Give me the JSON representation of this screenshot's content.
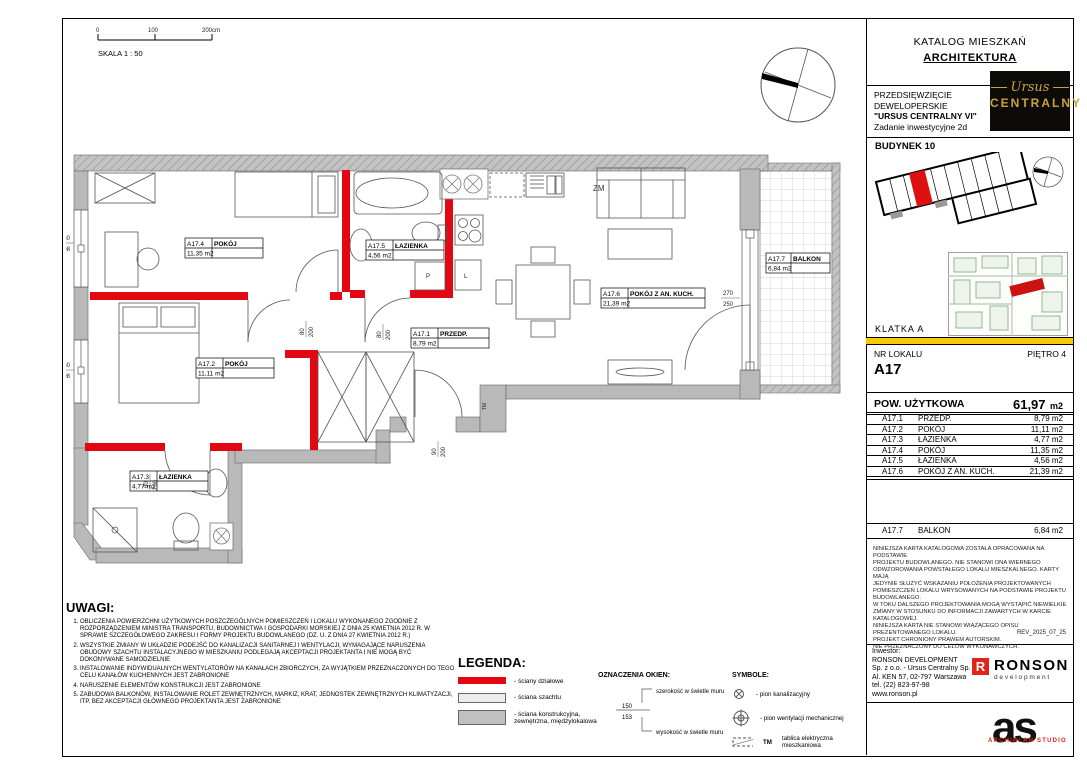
{
  "header": {
    "catalog_title": "KATALOG MIESZKAŃ",
    "catalog_subtitle": "ARCHITEKTURA"
  },
  "project": {
    "line1": "PRZEDSIĘWZIĘCIE",
    "line2": "DEWELOPERSKIE",
    "line3": "\"URSUS CENTRALNY VI\"",
    "line4": "Zadanie inwestycyjne 2d",
    "brand_script": "Ursus",
    "brand_caps": "CENTRALNY"
  },
  "building": {
    "name": "BUDYNEK 10",
    "klatka": "KLATKA  A"
  },
  "unit": {
    "nr_label": "NR LOKALU",
    "nr_value": "A17",
    "floor": "PIĘTRO 4",
    "area_label": "POW. UŻYTKOWA",
    "area_value": "61,97",
    "area_unit": "m2"
  },
  "rooms": [
    {
      "id": "A17.1",
      "name": "PRZEDP.",
      "area": "8,79 m2"
    },
    {
      "id": "A17.2",
      "name": "POKÓJ",
      "area": "11,11 m2"
    },
    {
      "id": "A17.3",
      "name": "ŁAZIENKA",
      "area": "4,77 m2"
    },
    {
      "id": "A17.4",
      "name": "POKÓJ",
      "area": "11,35 m2"
    },
    {
      "id": "A17.5",
      "name": "ŁAZIENKA",
      "area": "4,56 m2"
    },
    {
      "id": "A17.6",
      "name": "POKÓJ Z AN. KUCH.",
      "area": "21,39 m2"
    }
  ],
  "balcony": {
    "id": "A17.7",
    "name": "BALKON",
    "area": "6,84 m2"
  },
  "plan": {
    "scale_label": "SKALA 1 : 50",
    "tick0": "0",
    "tick1": "100",
    "tick2": "200cm",
    "zm": "ZM",
    "tm": "TM",
    "cab_p": "P",
    "cab_l": "L",
    "dims": {
      "door_w": "80",
      "door_h": "200",
      "entr_w": "90",
      "balc_w": "270",
      "balc_h": "250",
      "win_w": "160",
      "win_h": "198"
    }
  },
  "uwagi": {
    "title": "UWAGI:",
    "items": [
      "OBLICZENIA POWIERZCHNI UŻYTKOWYCH POSZCZEGÓLNYCH POMIESZCZEŃ I LOKALU WYKONANEGO ZGODNIE Z ROZPORZĄDZENIEM MINISTRA TRANSPORTU, BUDOWNICTWA I GOSPODARKI MORSKIEJ Z DNIA 25 KWIETNIA 2012 R. W SPRAWIE SZCZEGÓŁOWEGO ZAKRESU I FORMY PROJEKTU BUDOWLANEGO (DZ. U. Z DNIA 27 KWIETNIA 2012 R.)",
      "WSZYSTKIE ZMIANY W UKŁADZIE PODEJŚĆ DO KANALIZACJI SANITARNEJ I WENTYLACJI, WYMAGAJĄCE NARUSZENIA OBUDOWY SZACHTU INSTALACYJNEGO W MIESZKANIU PODLEGAJĄ AKCEPTACJI PROJEKTANTA I NIE MOGĄ BYĆ DOKONYWANE SAMODZIELNIE",
      "INSTALOWANIE INDYWIDUALNYCH WENTYLATORÓW NA KANAŁACH ZBIORCZYCH, ZA WYJĄTKIEM PRZEZNACZONYCH DO TEGO CELU KANAŁÓW KUCHENNYCH JEST ZABRONIONE",
      "NARUSZENIE ELEMENTÓW KONSTRUKCJI JEST ZABRONIONE",
      "ZABUDOWA BALKONÓW, INSTALOWANIE ROLET ZEWNĘTRZNYCH, MARKIZ, KRAT, JEDNOSTEK ZEWNĘTRZNYCH KLIMATYZACJI, ITP. BEZ AKCEPTACJI GŁÓWNEGO PROJEKTANTA JEST ZABRONIONE"
    ]
  },
  "legend": {
    "title": "LEGENDA:",
    "item1": "- ściany działowe",
    "item2": "- ściana szachtu",
    "item3": "- ściana konstrukcyjna, zewnętrzna, międzylokalowa"
  },
  "windows_key": {
    "title": "OZNACZENIA OKIEN:",
    "width_label": "szerokość w świetle muru",
    "height_label": "wysokość w świetle muru",
    "sample_w": "150",
    "sample_h": "153"
  },
  "symbols": {
    "title": "SYMBOLE:",
    "item1": "- pion kanalizacyjny",
    "item2": "- pion wentylacji mechanicznej",
    "tm_abbr": "TM",
    "tm_label": "tablica elektryczna mieszkaniowa"
  },
  "legal": {
    "lines": [
      "NINIEJSZA KARTA KATALOGOWA ZOSTAŁA OPRACOWANA NA PODSTAWIE",
      "PROJEKTU BUDOWLANEGO. NIE STANOWI ONA WIERNEGO",
      "ODWZOROWANIA POWSTAŁEGO LOKALU MIESZKALNEGO. KARTY MAJĄ",
      "JEDYNIE SŁUŻYĆ WSKAZANIU POŁOŻENIA PROJEKTOWANYCH",
      "POMIESZCZEŃ LOKALU WRYSOWANYCH NA PODSTAWIE PROJEKTU",
      "BUDOWLANEGO.",
      "W TOKU DALSZEGO PROJEKTOWANIA MOGĄ WYSTĄPIĆ NIEWIELKIE",
      "ZMIANY W STOSUNKU DO INFORMACJI ZAWARTYCH W KARCIE",
      "KATALOGOWEJ.",
      "NINIEJSZA KARTA NIE STANOWI WIĄŻĄCEGO OPISU PREZENTOWANEGO LOKALU.",
      "PROJEKT CHRONIONY PRAWEM AUTORSKIM.",
      "NIE PRZEZNACZONY DO CELÓW WYKONAWCZYCH."
    ],
    "rev": "REV_2025_07_25"
  },
  "investor": {
    "label": "Inwestor:",
    "lines": [
      "RONSON DEVELOPMENT",
      "Sp. z o.o. - Ursus Centralny Sp. K.",
      "Al. KEN 57, 02-797 Warszawa",
      "tel. (22) 823-97-98",
      "www.ronson.pl"
    ],
    "logo_r": "R",
    "logo_name": "RONSON",
    "logo_sub": "development"
  },
  "archiplan": {
    "letters": "as",
    "label": "ARCHIPLAN STUDIO"
  }
}
